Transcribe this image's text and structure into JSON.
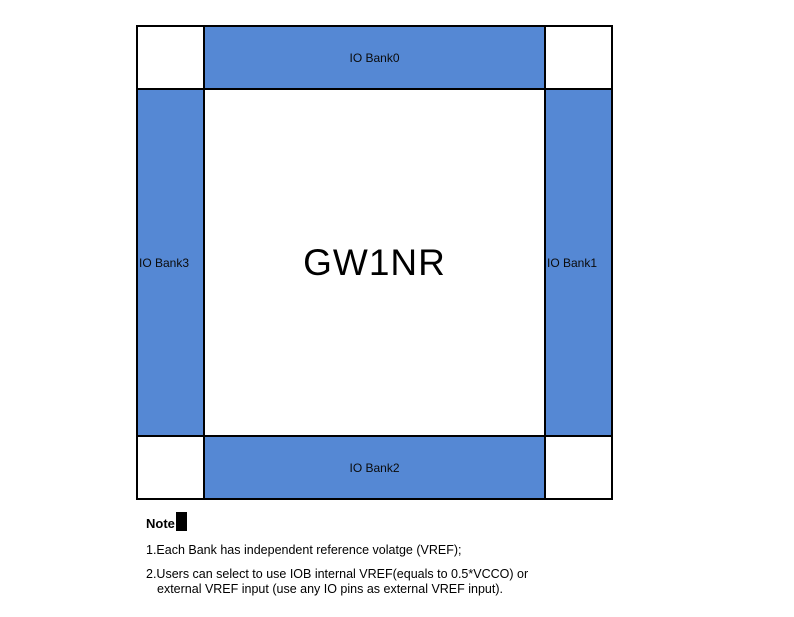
{
  "diagram": {
    "chip_label": "GW1NR",
    "banks": {
      "top": {
        "label": "IO Bank0"
      },
      "right": {
        "label": "IO Bank1"
      },
      "bottom": {
        "label": "IO Bank2"
      },
      "left": {
        "label": "IO Bank3"
      }
    },
    "colors": {
      "bank_fill": "#5588d4",
      "border": "#000000",
      "background": "#ffffff"
    }
  },
  "notes": {
    "heading": "Note",
    "items": [
      "1.Each Bank has independent reference volatge (VREF);",
      "2.Users can select to use IOB internal VREF(equals to 0.5*VCCO) or",
      "external VREF input (use any IO pins as external VREF input)."
    ]
  }
}
